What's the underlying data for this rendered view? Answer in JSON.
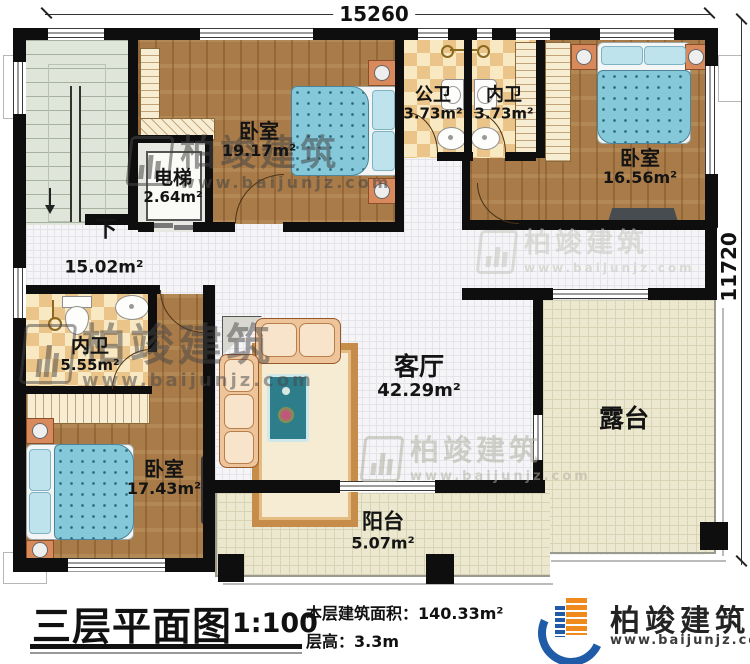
{
  "dimensions": {
    "width_mm": "15260",
    "height_mm": "11720"
  },
  "rooms": {
    "bedroom_top": {
      "name": "卧室",
      "area": "19.17m²"
    },
    "public_bath": {
      "name": "公卫",
      "area": "3.73m²"
    },
    "ensuite_top": {
      "name": "内卫",
      "area": "3.73m²"
    },
    "bedroom_right": {
      "name": "卧室",
      "area": "16.56m²"
    },
    "elevator": {
      "name": "电梯",
      "area": "2.64m²"
    },
    "hallway": {
      "area": "15.02m²",
      "stairs_note": "下"
    },
    "ensuite_left": {
      "name": "内卫",
      "area": "5.55m²"
    },
    "bedroom_bottom": {
      "name": "卧室",
      "area": "17.43m²"
    },
    "living": {
      "name": "客厅",
      "area": "42.29m²"
    },
    "terrace": {
      "name": "露台"
    },
    "balcony": {
      "name": "阳台",
      "area": "5.07m²"
    }
  },
  "title_block": {
    "title": "三层平面图",
    "scale": "1:100",
    "floor_area": "本层建筑面积：140.33m²",
    "floor_height": "层高：3.3m"
  },
  "brand": {
    "name": "柏竣建筑",
    "website": "www.baijunjz.com"
  },
  "watermark": {
    "name": "柏竣建筑",
    "website": "www.baijunjz.com"
  },
  "colors": {
    "wood_floor": "#a87b48",
    "bath_tile": "#eac488",
    "outdoor_tile": "#ece8cf",
    "bed_blanket": "#85c8da",
    "sofa": "#eec49b",
    "logo_blue": "#1f5ba6",
    "logo_orange": "#ef8b1d"
  }
}
